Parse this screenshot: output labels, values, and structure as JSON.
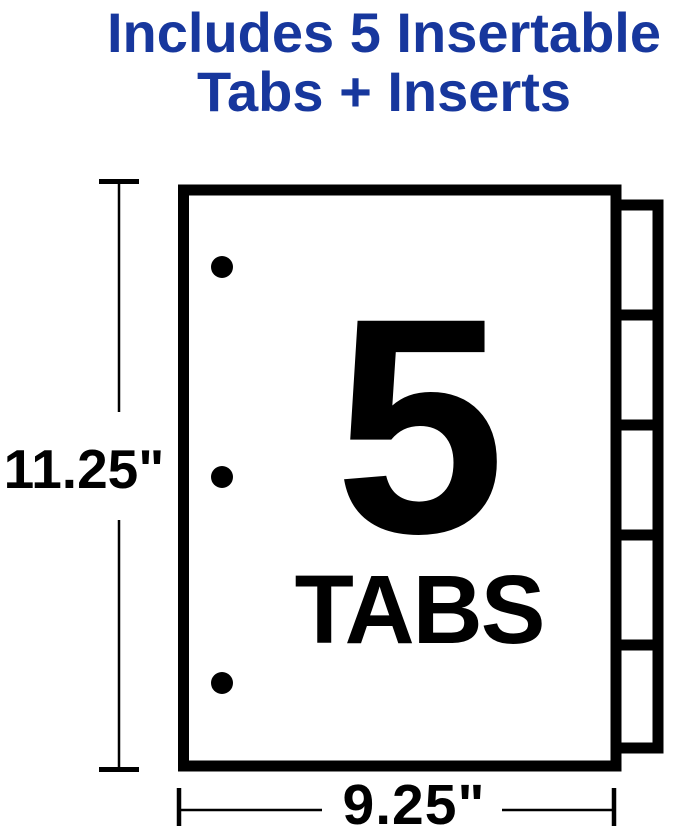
{
  "colors": {
    "accent_blue": "#17379D",
    "ink": "#000000",
    "background": "#FFFFFF"
  },
  "heading": {
    "line1": "Includes 5 Insertable",
    "line2": "Tabs + Inserts"
  },
  "diagram": {
    "big_number": "5",
    "big_label": "TABS",
    "height_label": "11.25\"",
    "width_label": "9.25\"",
    "tab_count": 5,
    "hole_count": 3
  }
}
